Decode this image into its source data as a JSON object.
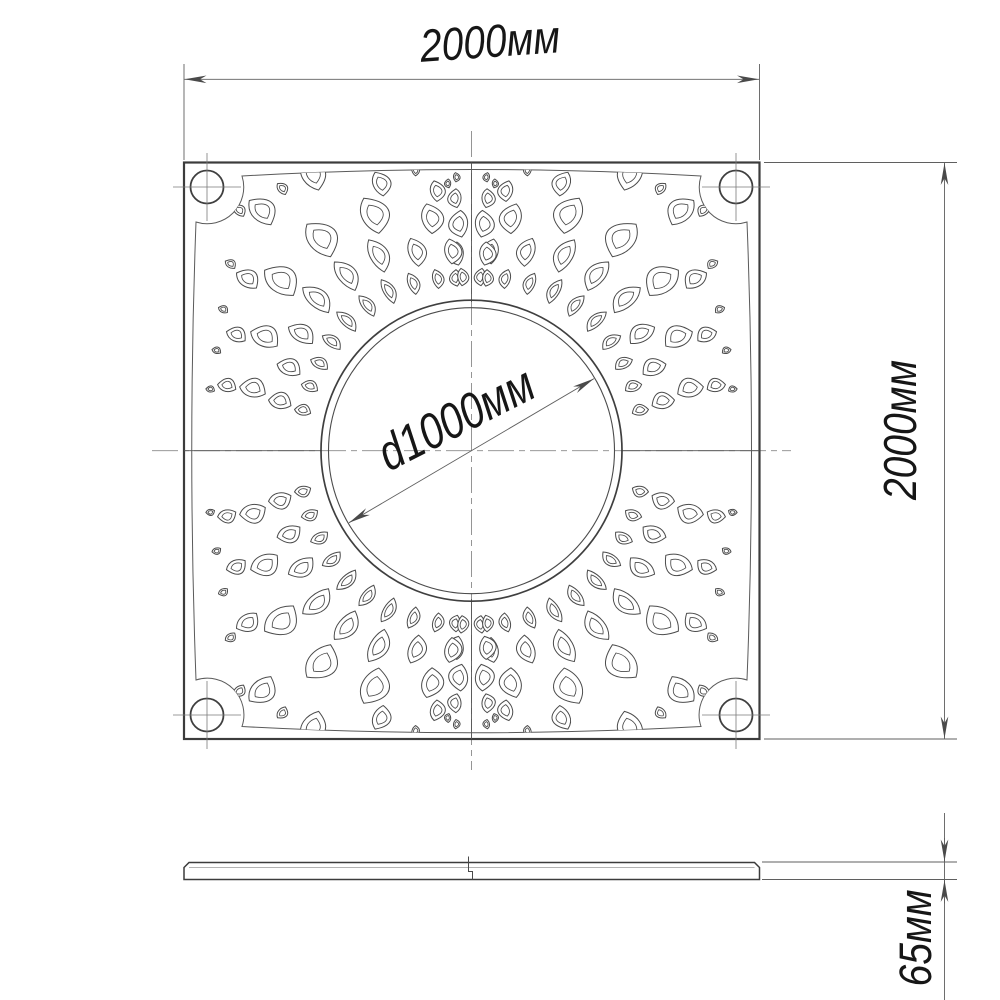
{
  "drawing": {
    "type_note": "tree-grate technical drawing",
    "top_view": {
      "width_label": "2000мм",
      "height_label": "2000мм",
      "hole_diameter_label": "d1000мм"
    },
    "side_view": {
      "thickness_label": "65мм"
    },
    "values": {
      "width_mm": 2000,
      "height_mm": 2000,
      "hole_diameter_mm": 1000,
      "thickness_mm": 65
    },
    "colors": {
      "background": "#ffffff",
      "outline": "#3c3c3c",
      "pattern_line": "#4b4b4b",
      "dim_line": "#5f5f5f",
      "centerline": "#8a8a8a",
      "text": "#161616",
      "arrow": "#4a4a4a"
    }
  }
}
